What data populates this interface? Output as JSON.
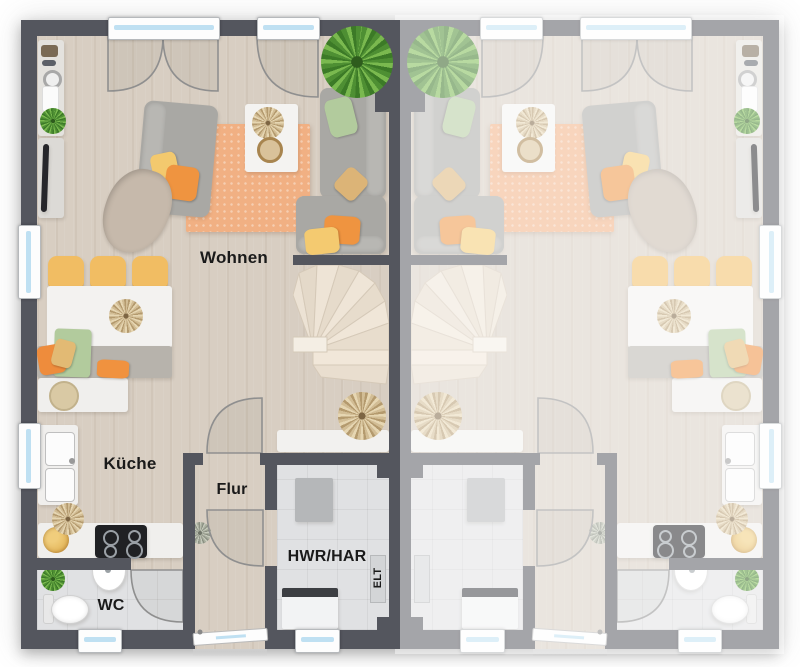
{
  "plan": {
    "type": "residential floor plan, semi-detached house, two mirrored units",
    "units": {
      "left": {
        "labels_shown": true,
        "faded": false,
        "mirrored": false
      },
      "right": {
        "labels_shown": false,
        "faded": true,
        "mirrored": true
      }
    }
  },
  "rooms": {
    "living": {
      "label": "Wohnen"
    },
    "kitchen": {
      "label": "Küche"
    },
    "hall": {
      "label": "Flur"
    },
    "utility": {
      "label": "HWR/HAR"
    },
    "electrical": {
      "label": "ELT"
    },
    "wc": {
      "label": "WC"
    }
  },
  "colors": {
    "wall": "#54565e",
    "floor_wood": "#d8cec2",
    "floor_tile": "#e0e1e3",
    "rug": "#f1b083",
    "sofa": "#a9a8a4",
    "glass": "#bfe0f2",
    "label": "#1a1a1a",
    "stairs": "#ece2d4",
    "accent_orange": "#ef8e3d",
    "accent_yellow": "#f2c267",
    "accent_green": "#aec99b"
  }
}
